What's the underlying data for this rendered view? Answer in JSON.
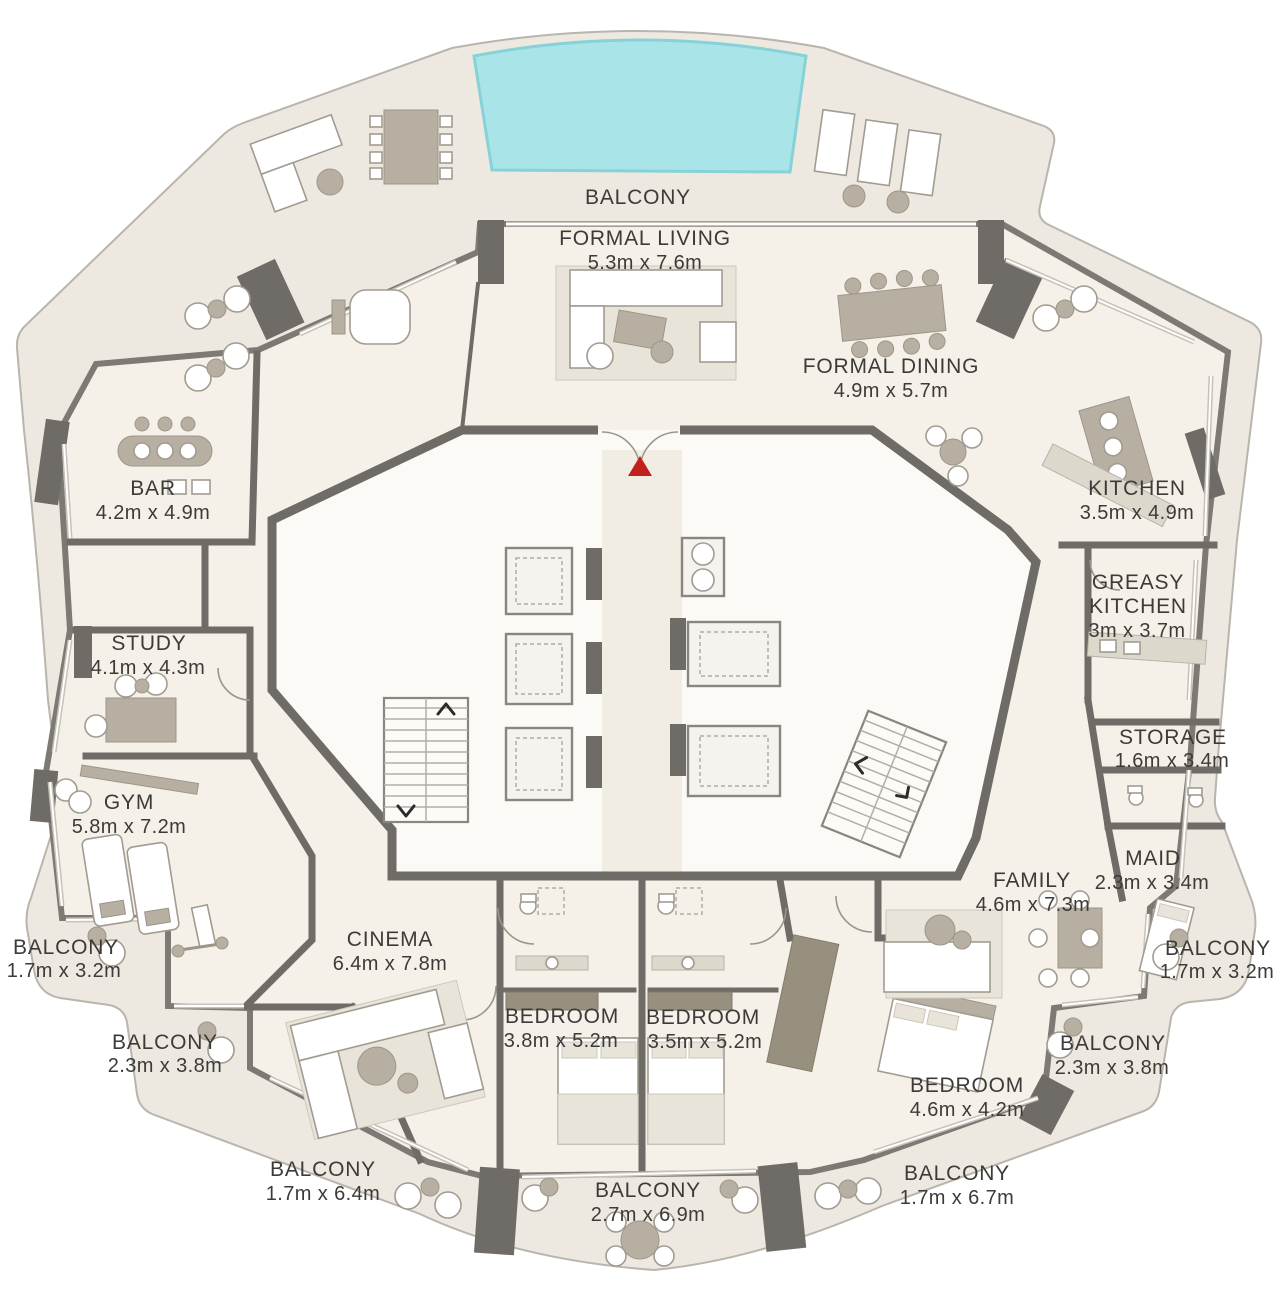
{
  "colors": {
    "balcony_floor": "#eee9e0",
    "interior_floor": "#f6f1e8",
    "wall": "#6f6b66",
    "window_line": "#c6c2b9",
    "pool": "#a9e5e8",
    "pool_edge": "#86d2d6",
    "furniture_gray": "#b7afa2",
    "furniture_light": "#e9e4d9",
    "furniture_white": "#ffffff",
    "furniture_stroke": "#a19b91",
    "wardrobe": "#97907f",
    "entry_marker": "#c2201d",
    "label_text": "#3c3b39"
  },
  "rooms": {
    "formal_living": {
      "name": "FORMAL LIVING",
      "dims": "5.3m x 7.6m"
    },
    "formal_dining": {
      "name": "FORMAL DINING",
      "dims": "4.9m x 5.7m"
    },
    "kitchen": {
      "name": "KITCHEN",
      "dims": "3.5m x 4.9m"
    },
    "greasy_kitchen": {
      "name_line1": "GREASY",
      "name_line2": "KITCHEN",
      "dims": "3m x 3.7m"
    },
    "bar": {
      "name": "BAR",
      "dims": "4.2m x 4.9m"
    },
    "study": {
      "name": "STUDY",
      "dims": "4.1m x 4.3m"
    },
    "gym": {
      "name": "GYM",
      "dims": "5.8m x 7.2m"
    },
    "storage": {
      "name": "STORAGE",
      "dims": "1.6m x 3.4m"
    },
    "maid": {
      "name": "MAID",
      "dims": "2.3m x 3.4m"
    },
    "family": {
      "name": "FAMILY",
      "dims": "4.6m x 7.3m"
    },
    "cinema": {
      "name": "CINEMA",
      "dims": "6.4m x 7.8m"
    },
    "bedroom_1": {
      "name": "BEDROOM",
      "dims": "3.8m x 5.2m"
    },
    "bedroom_2": {
      "name": "BEDROOM",
      "dims": "3.5m x 5.2m"
    },
    "bedroom_3": {
      "name": "BEDROOM",
      "dims": "4.6m x 4.2m"
    }
  },
  "balconies": {
    "top": {
      "name": "BALCONY"
    },
    "left_upper": {
      "name": "BALCONY",
      "dims": "1.7m x 3.2m"
    },
    "left_lower": {
      "name": "BALCONY",
      "dims": "2.3m x 3.8m"
    },
    "bottom_left": {
      "name": "BALCONY",
      "dims": "1.7m x 6.4m"
    },
    "bottom_center": {
      "name": "BALCONY",
      "dims": "2.7m x 6.9m"
    },
    "bottom_right": {
      "name": "BALCONY",
      "dims": "1.7m x 6.7m"
    },
    "right_upper": {
      "name": "BALCONY",
      "dims": "1.7m x 3.2m"
    },
    "right_lower": {
      "name": "BALCONY",
      "dims": "2.3m x 3.8m"
    }
  }
}
